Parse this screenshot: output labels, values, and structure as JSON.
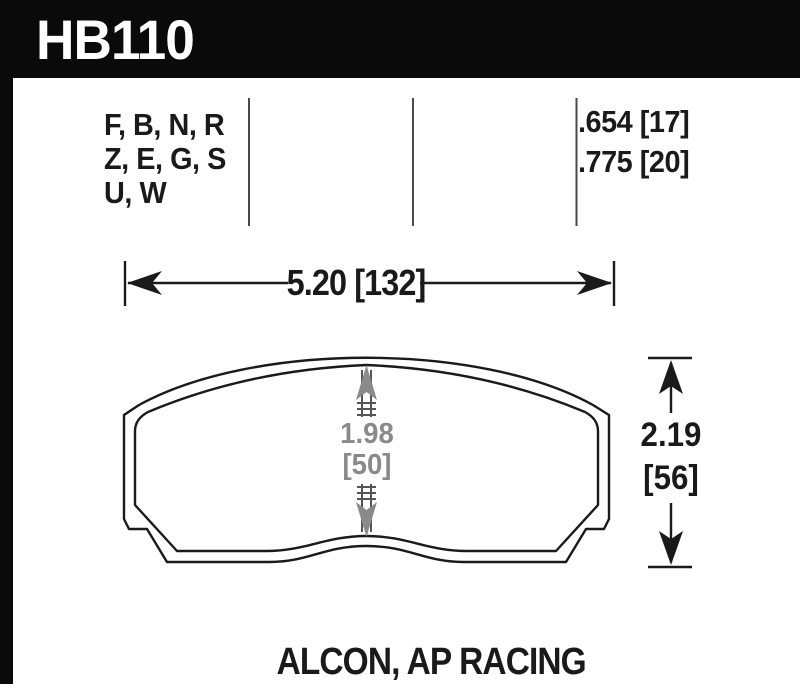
{
  "header": {
    "part_number": "HB110"
  },
  "spec_table": {
    "compound_lines": [
      "F, B, N, R",
      "Z, E, G, S",
      "U, W"
    ],
    "thickness_lines": [
      ".654 [17]",
      ".775 [20]"
    ]
  },
  "dimensions": {
    "width_label": "5.20 [132]",
    "center_in": "1.98",
    "center_mm": "[50]",
    "height_in": "2.19",
    "height_mm": "[56]"
  },
  "footer": {
    "applications": "ALCON, AP RACING"
  },
  "colors": {
    "band_black": "#0a0a0a",
    "line_black": "#1a1a1a",
    "divider_gray": "#4a4a4a",
    "dim_gray": "#8a8a8a"
  }
}
